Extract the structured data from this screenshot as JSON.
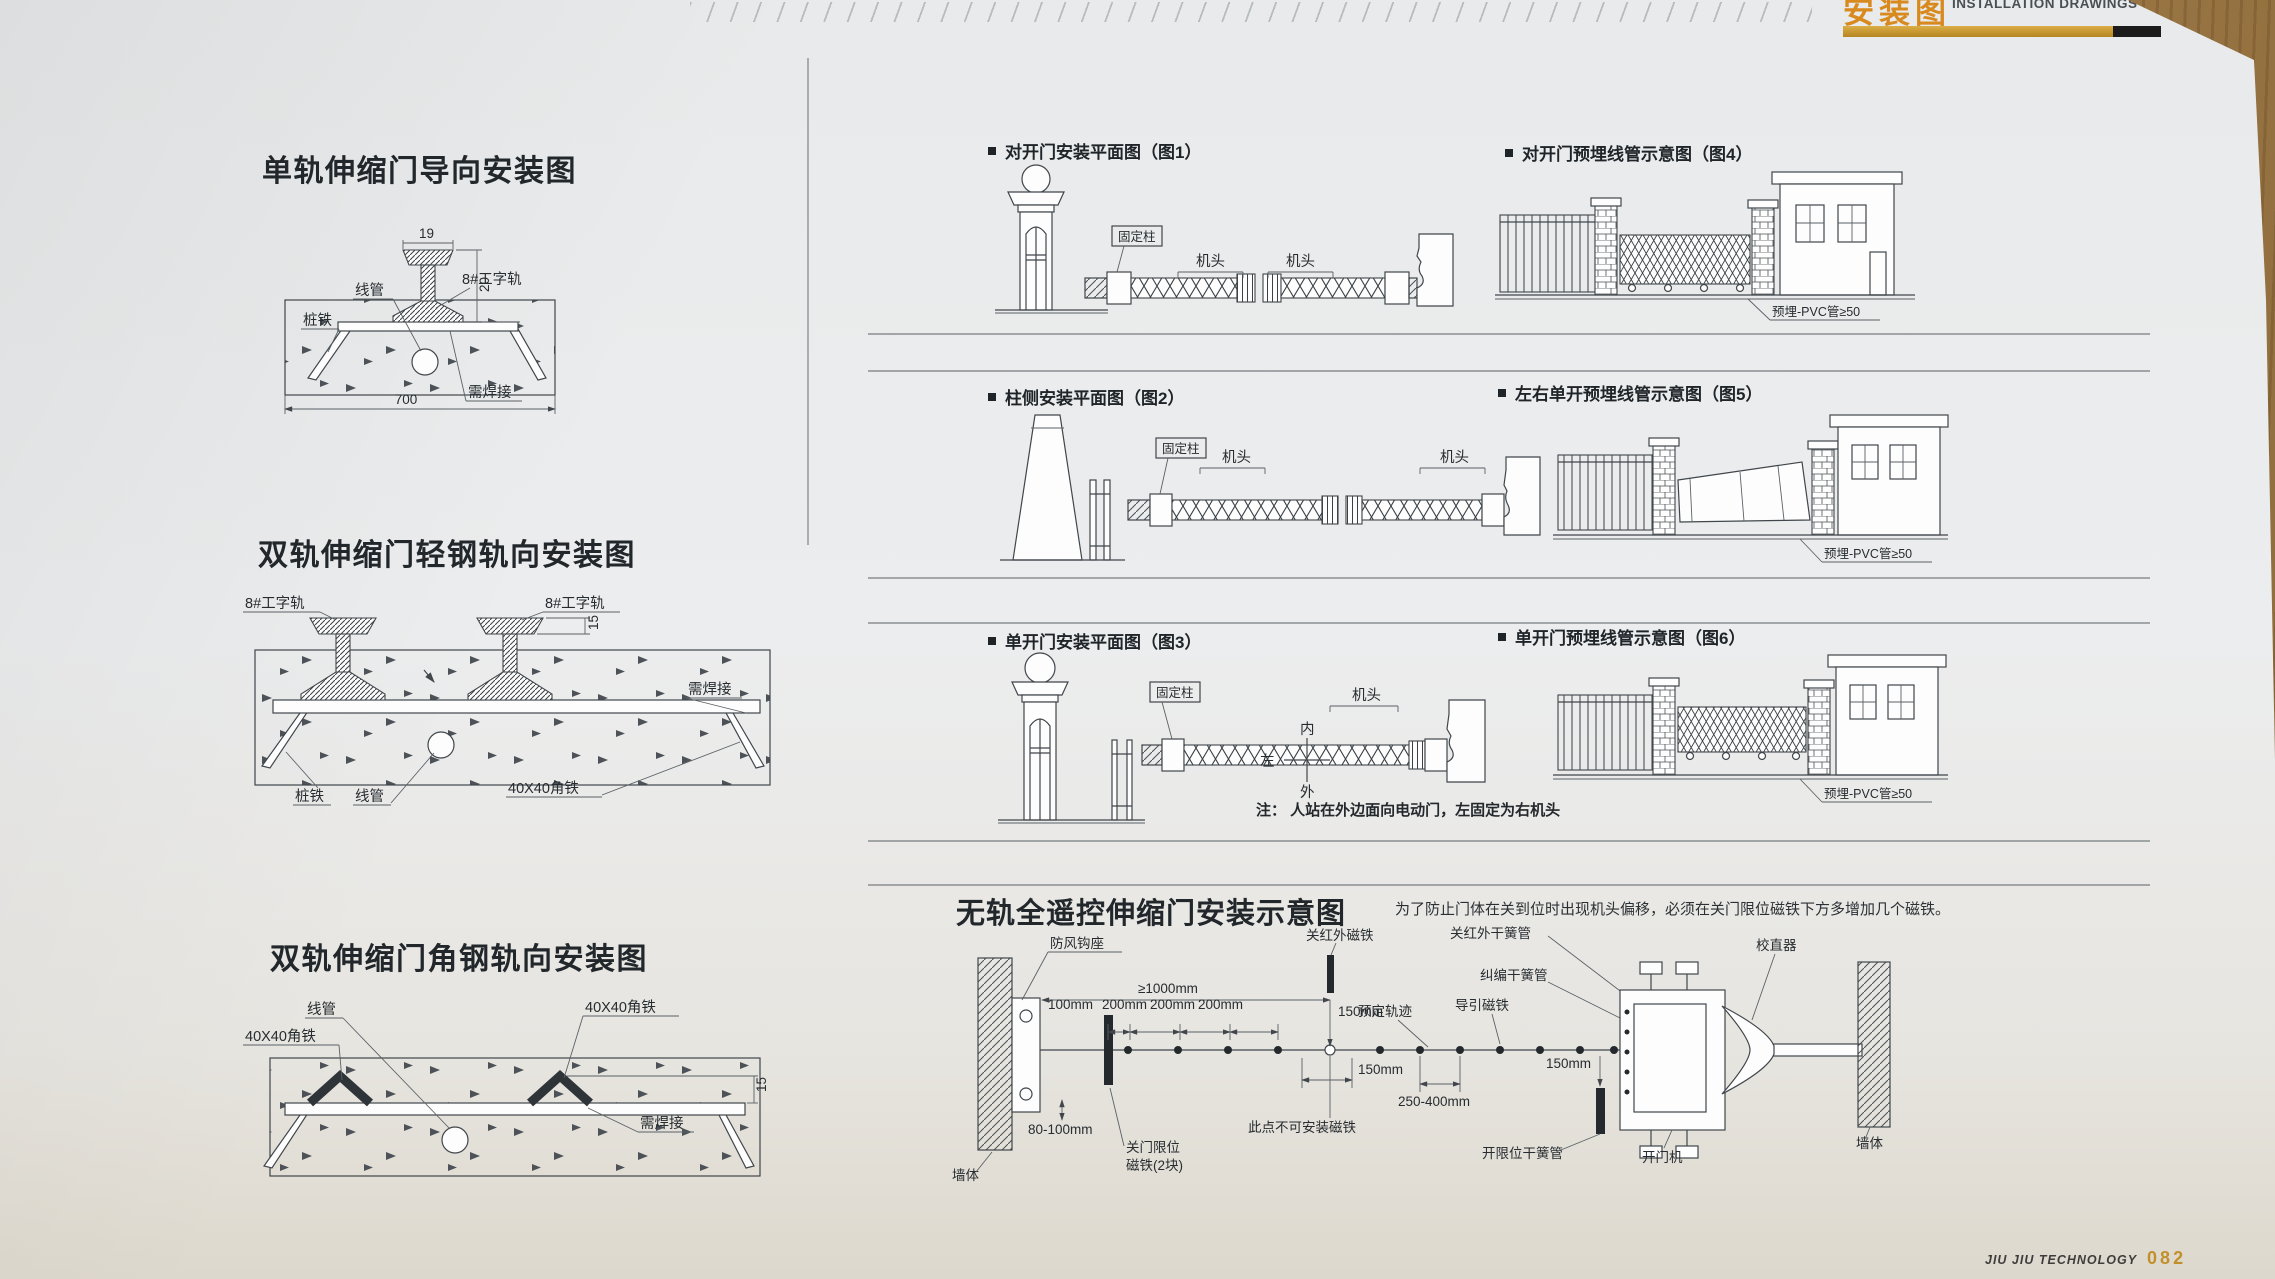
{
  "header": {
    "title_cn": "安装图",
    "title_en": "INSTALLATION DRAWINGS"
  },
  "footer": {
    "brand": "JIU JIU TECHNOLOGY",
    "page_number": "082"
  },
  "left_column": {
    "diagram1": {
      "title": "单轨伸缩门导向安装图",
      "labels": {
        "conduit": "线管",
        "pile_iron": "桩铁",
        "rail": "8#工字轨",
        "weld": "需焊接"
      },
      "dims": {
        "w19": "19",
        "h20": "20",
        "w700": "700"
      }
    },
    "diagram2": {
      "title": "双轨伸缩门轻钢轨向安装图",
      "labels": {
        "rail_left": "8#工字轨",
        "rail_right": "8#工字轨",
        "weld": "需焊接",
        "pile_iron": "桩铁",
        "conduit": "线管",
        "angle_iron": "40X40角铁"
      },
      "dims": {
        "h15": "15"
      }
    },
    "diagram3": {
      "title": "双轨伸缩门角钢轨向安装图",
      "labels": {
        "conduit": "线管",
        "angle_iron_left": "40X40角铁",
        "angle_iron_right": "40X40角铁",
        "weld": "需焊接"
      },
      "dims": {
        "h15": "15"
      }
    }
  },
  "right_column": {
    "rows": [
      {
        "left_caption": "对开门安装平面图（图1）",
        "right_caption": "对开门预埋线管示意图（图4）"
      },
      {
        "left_caption": "柱侧安装平面图（图2）",
        "right_caption": "左右单开预埋线管示意图（图5）"
      },
      {
        "left_caption": "单开门安装平面图（图3）",
        "right_caption": "单开门预埋线管示意图（图6）"
      }
    ],
    "shared_labels": {
      "fixed_post": "固定柱",
      "machine_head": "机头",
      "guard_room": "警卫室",
      "pvc_pipe": "预埋-PVC管≥50"
    },
    "figure3": {
      "dir_inner": "内",
      "dir_outer": "外",
      "dir_left": "左",
      "note": "注： 人站在外边面向电动门，左固定为右机头"
    }
  },
  "bottom_section": {
    "title": "无轨全遥控伸缩门安装示意图",
    "note": "为了防止门体在关到位时出现机头偏移，必须在关门限位磁铁下方多增加几个磁铁。",
    "labels": {
      "wind_hook": "防风钩座",
      "close_ir_magnet": "关红外磁铁",
      "close_ir_reed": "关红外干簧管",
      "straightener": "校直器",
      "deviation_reed": "纠编干簧管",
      "guide_magnet": "导引磁铁",
      "planned_track": "预定轨迹",
      "no_magnet_here": "此点不可安装磁铁",
      "close_limit_line1": "关门限位",
      "close_limit_line2": "磁铁(2块)",
      "open_limit_reed": "开限位干簧管",
      "door_opener": "开门机",
      "wall": "墙体"
    },
    "dims": {
      "gte1000": "≥1000mm",
      "d100": "100mm",
      "d200": "200mm",
      "d150": "150mm",
      "d250_400": "250-400mm",
      "d80_100": "80-100mm"
    }
  }
}
